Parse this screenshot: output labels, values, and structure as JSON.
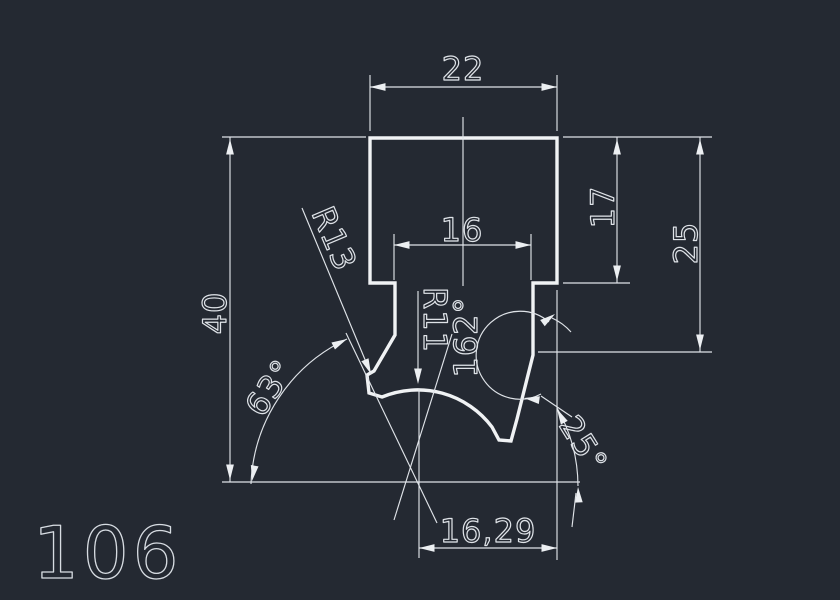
{
  "drawing": {
    "part_label": "106",
    "labels": {
      "width_top": "22",
      "width_neck": "16",
      "depth_step": "17",
      "depth_shoulder": "25",
      "height_total": "40",
      "radius_flank": "R13",
      "radius_bottom": "R11",
      "angle_vertex": "162°",
      "angle_flank": "63°",
      "angle_edge": "25°",
      "width_bottom": "16,29"
    },
    "colors": {
      "background": "#242932",
      "line": "#eceff2",
      "text": "#dfe3e8"
    }
  }
}
